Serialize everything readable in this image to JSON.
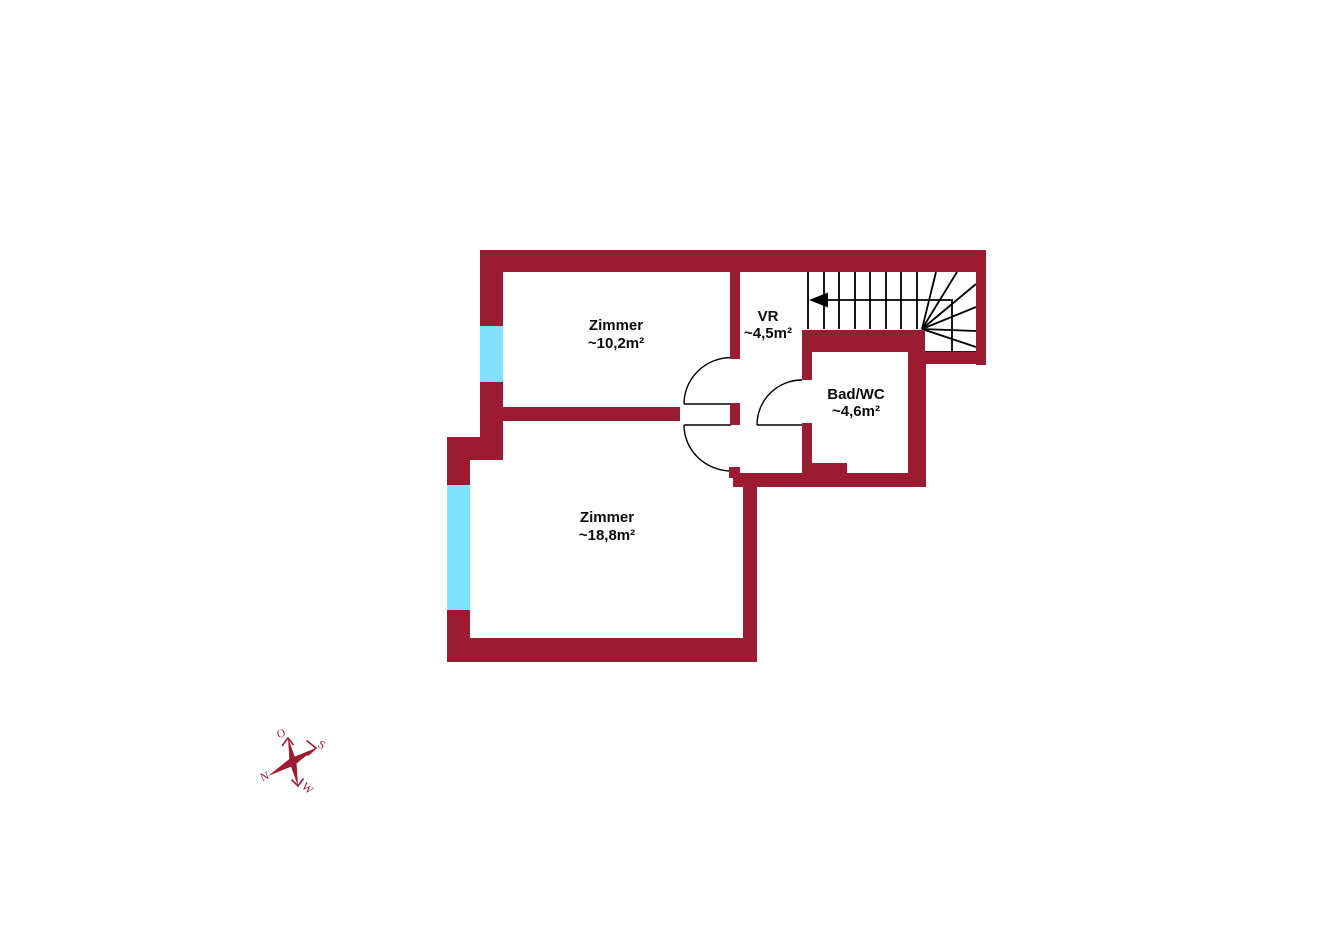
{
  "title": "floor-plan",
  "colors": {
    "wall": "#9b1b32",
    "window": "#7ee3fa",
    "line": "#000000",
    "label": "#0c0c0c"
  },
  "rooms": [
    {
      "name": "Zimmer",
      "area": "~10,2m²"
    },
    {
      "name": "VR",
      "area": "~4,5m²"
    },
    {
      "name": "Bad/WC",
      "area": "~4,6m²"
    },
    {
      "name": "Zimmer",
      "area": "~18,8m²"
    }
  ],
  "compass": {
    "east": "O",
    "south": "S",
    "north": "N",
    "west": "W"
  }
}
